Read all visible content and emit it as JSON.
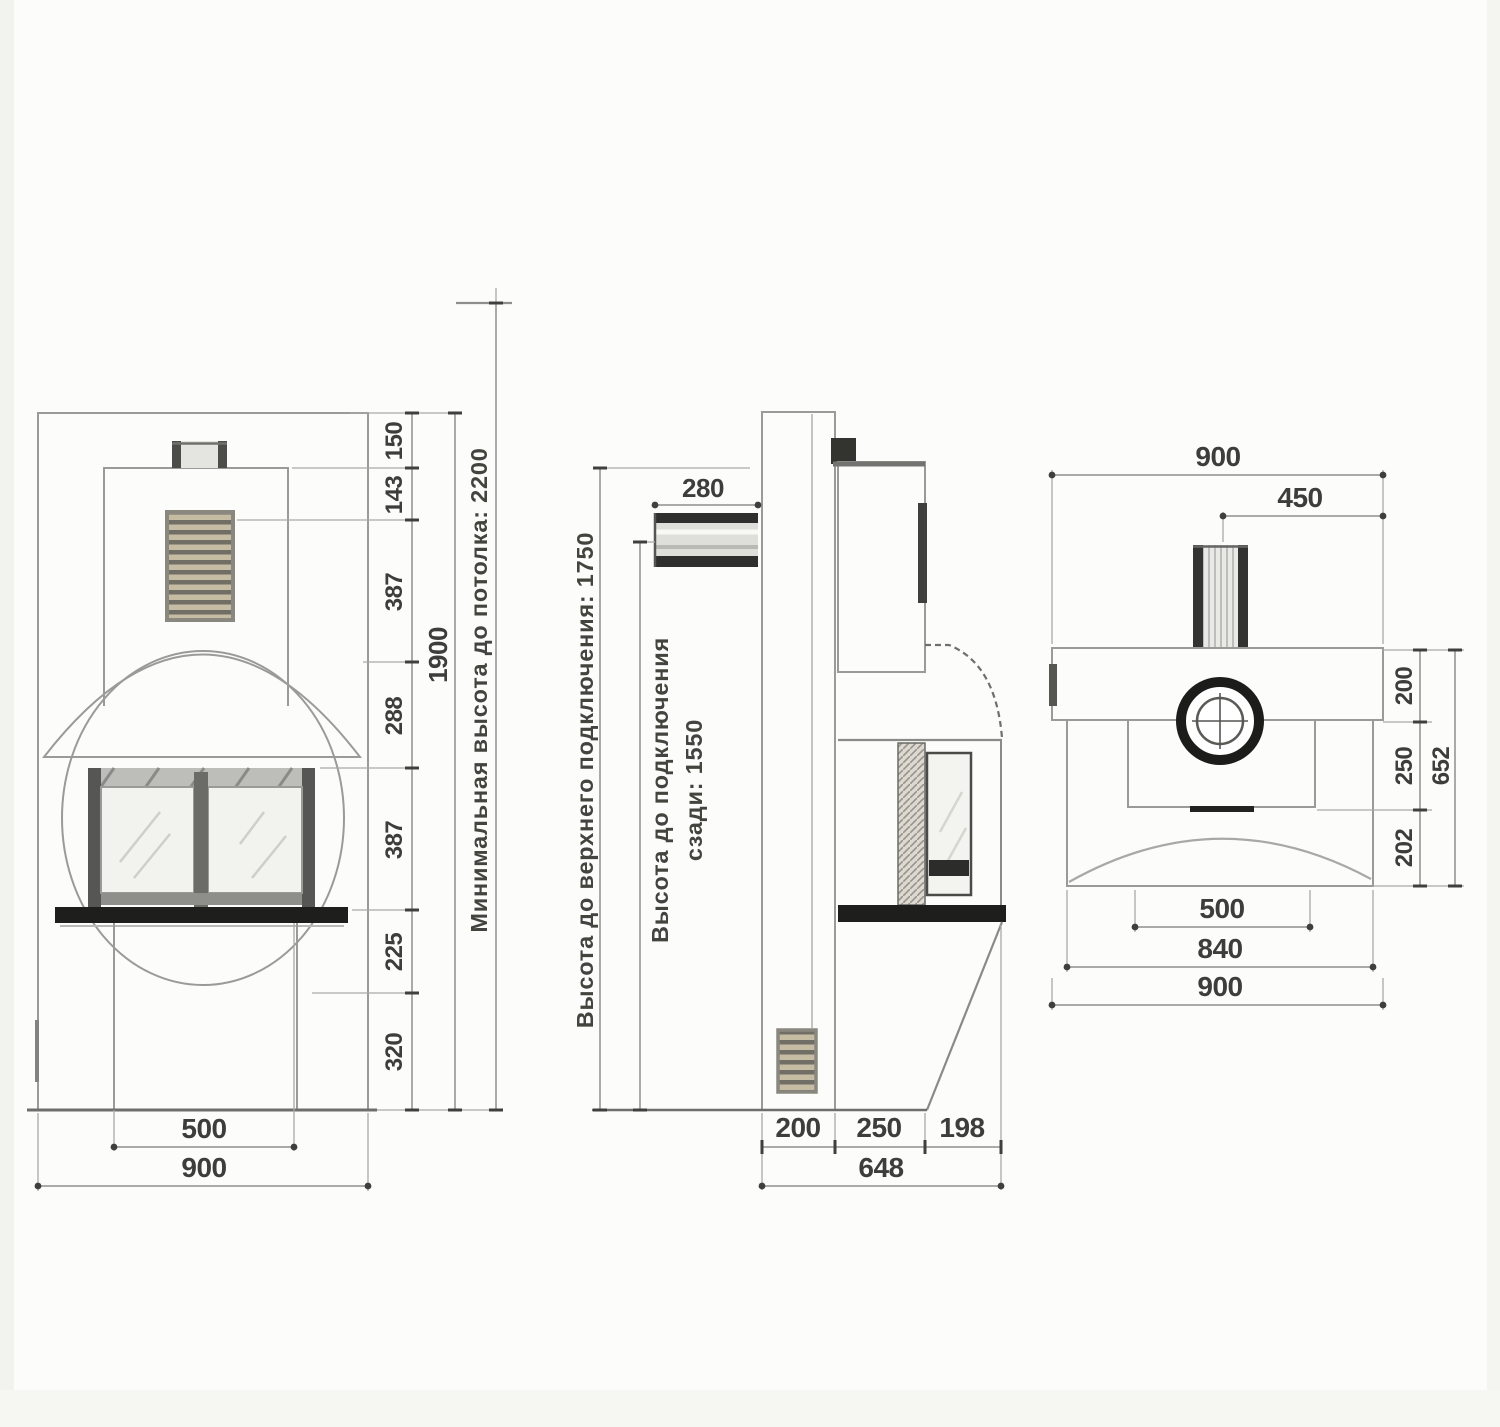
{
  "front": {
    "chain": [
      "150",
      "143",
      "387",
      "288",
      "387",
      "225",
      "320"
    ],
    "total": "1900",
    "ceiling_note": "Минимальная высота до потолка: 2200",
    "opening_width": "500",
    "overall_width": "900"
  },
  "side": {
    "pipe_width": "280",
    "upper_note": "Высота до верхнего подключения: 1750",
    "rear_note_line1": "Высота до подключения",
    "rear_note_line2": "сзади: 1550",
    "depth": [
      "200",
      "250",
      "198"
    ],
    "total_depth": "648"
  },
  "top": {
    "overall_width_top": "900",
    "half_width": "450",
    "right": [
      "200",
      "250",
      "202"
    ],
    "right_total": "652",
    "opening_width": "500",
    "body_width": "840",
    "base_width": "900"
  }
}
